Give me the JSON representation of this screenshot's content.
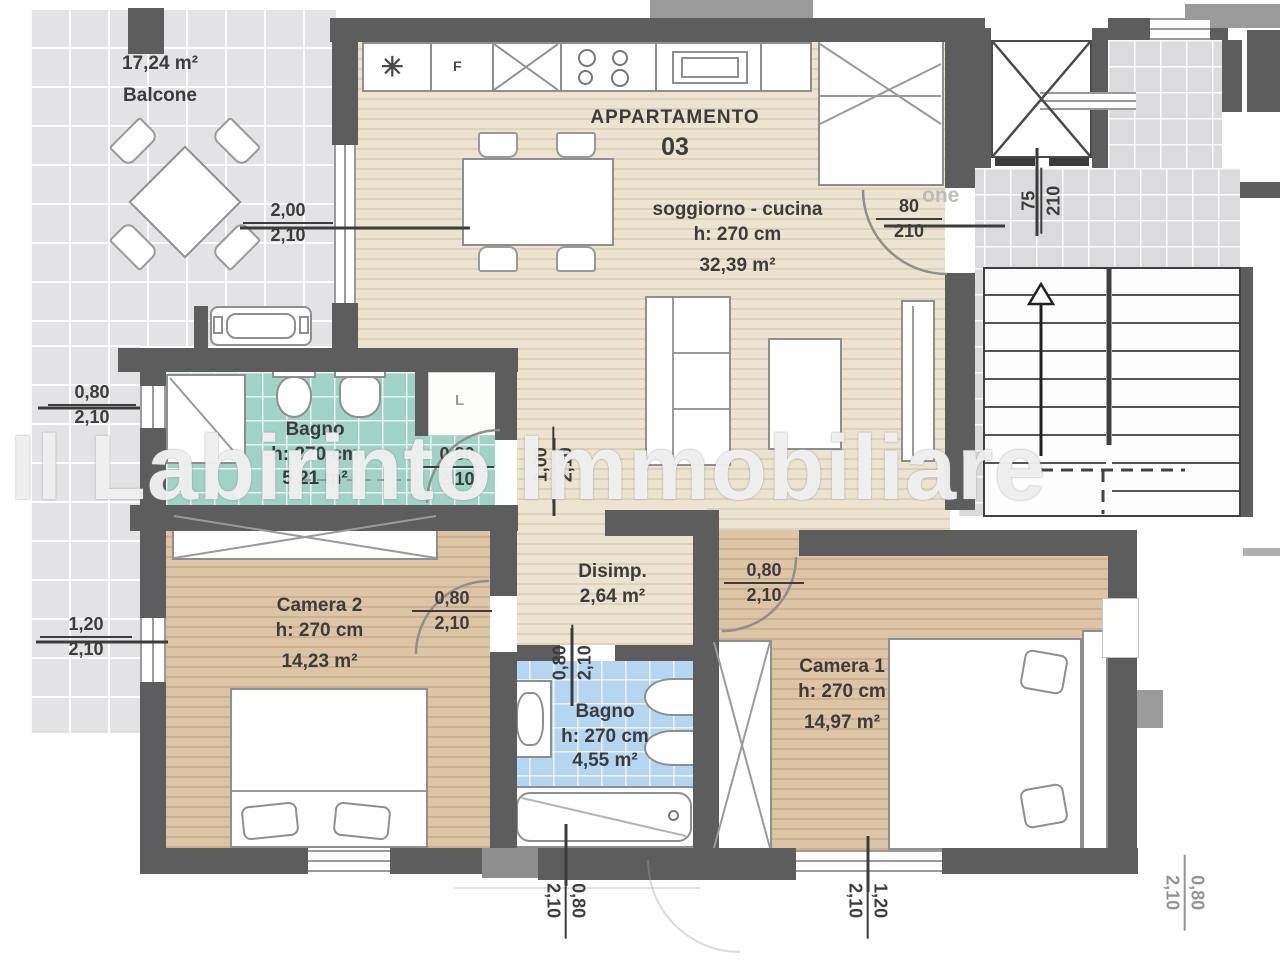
{
  "title": {
    "line1": "APPARTAMENTO",
    "line2": "03"
  },
  "watermark": "Il Labirinto Immobiliare",
  "ghost_text": "one",
  "balcony": {
    "area": "17,24 m²",
    "name": "Balcone"
  },
  "rooms": {
    "soggiorno": {
      "name": "soggiorno - cucina",
      "height": "h: 270 cm",
      "area": "32,39 m²"
    },
    "bagno1": {
      "name": "Bagno",
      "height": "h: 270 cm",
      "area": "5,21 m²"
    },
    "disimpegno": {
      "name": "Disimp.",
      "area": "2,64 m²"
    },
    "camera2": {
      "name": "Camera 2",
      "height": "h: 270 cm",
      "area": "14,23 m²"
    },
    "bagno2": {
      "name": "Bagno",
      "height": "h: 270 cm",
      "area": "4,55 m²"
    },
    "camera1": {
      "name": "Camera 1",
      "height": "h: 270 cm",
      "area": "14,97 m²"
    }
  },
  "dimensions": {
    "balcony_door": {
      "width": "2,00",
      "height": "2,10"
    },
    "bagno1_window": {
      "width": "0,80",
      "height": "2,10"
    },
    "entrance_door": {
      "width": "80",
      "height": "210"
    },
    "elevator_door": {
      "width": "75",
      "height": "210"
    },
    "bagno1_door": {
      "width": "0,80",
      "height": "2,10"
    },
    "corridor_opening": {
      "width": "1,00",
      "height": "2,10"
    },
    "camera2_door": {
      "width": "0,80",
      "height": "2,10"
    },
    "camera2_window": {
      "width": "1,20",
      "height": "2,10"
    },
    "camera1_door": {
      "width": "0,80",
      "height": "2,10"
    },
    "bagno2_door": {
      "width": "0,80",
      "height": "2,10"
    },
    "bagno2_window": {
      "width": "0,80",
      "height": "2,10"
    },
    "camera1_window": {
      "width": "1,20",
      "height": "2,10"
    },
    "neighbor_window": {
      "width": "0,80",
      "height": "2,10"
    }
  },
  "icons": {
    "freezer": "✳",
    "letter_f": "F",
    "washer_niche": "L"
  }
}
